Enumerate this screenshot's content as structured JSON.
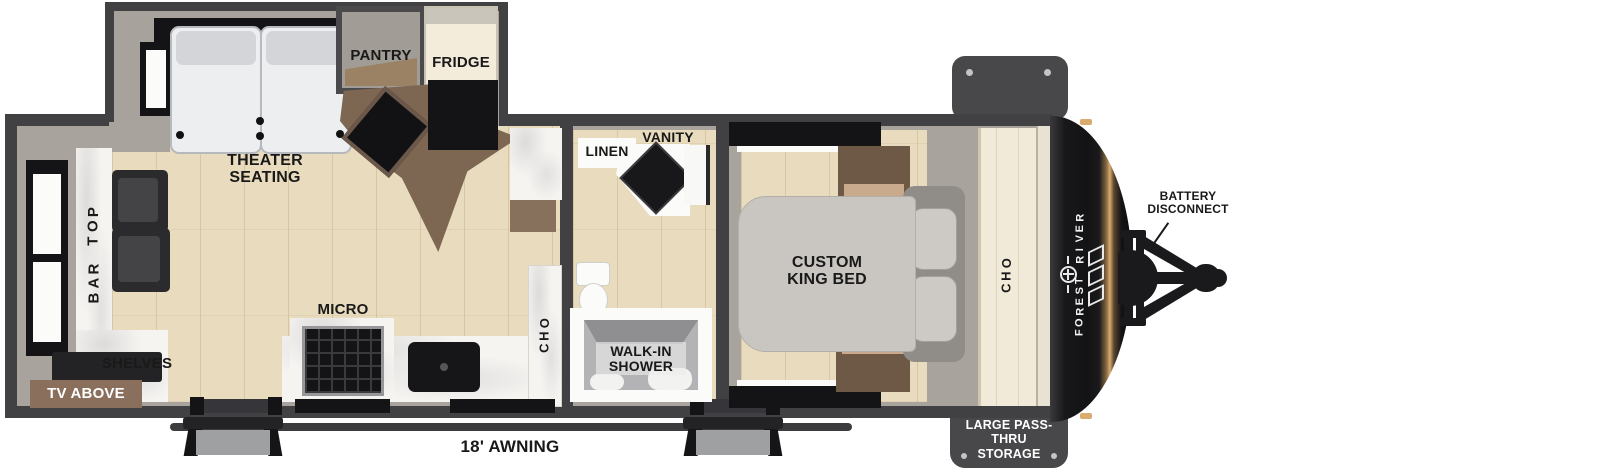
{
  "image_type": "rv-travel-trailer-floorplan",
  "colors": {
    "wall": "#414143",
    "interior_gray": "#a8a49d",
    "floor_tan": "#e9dcbe",
    "counter_marble": "#f5f4f1",
    "cabinet_brown": "#6e5947",
    "tv_shelf_brown": "#8a6f5c",
    "bed_gray": "#c9c6c1",
    "front_cap_black": "#1b1b1d",
    "cap_gold_accent": "#d9ac6e",
    "exterior_tab_gray": "#48484a",
    "label_black": "#191919",
    "label_white": "#ffffff"
  },
  "labels": {
    "theater_seating": "THEATER SEATING",
    "pantry": "PANTRY",
    "fridge": "FRIDGE",
    "bar_top": "BAR TOP",
    "shelves": "SHELVES",
    "tv_above": "TV ABOVE",
    "micro": "MICRO",
    "ohc_kitchen": "OHC",
    "linen": "LINEN",
    "vanity": "VANITY",
    "walk_in_shower": "WALK-IN SHOWER",
    "custom_king_bed": "CUSTOM KING BED",
    "ohc_bedroom": "OHC",
    "battery_disconnect": "BATTERY DISCONNECT",
    "forest_river_brand": "FOREST RIVER",
    "large_pass_thru_storage": "LARGE PASS-THRU STORAGE",
    "awning": "18' AWNING"
  }
}
